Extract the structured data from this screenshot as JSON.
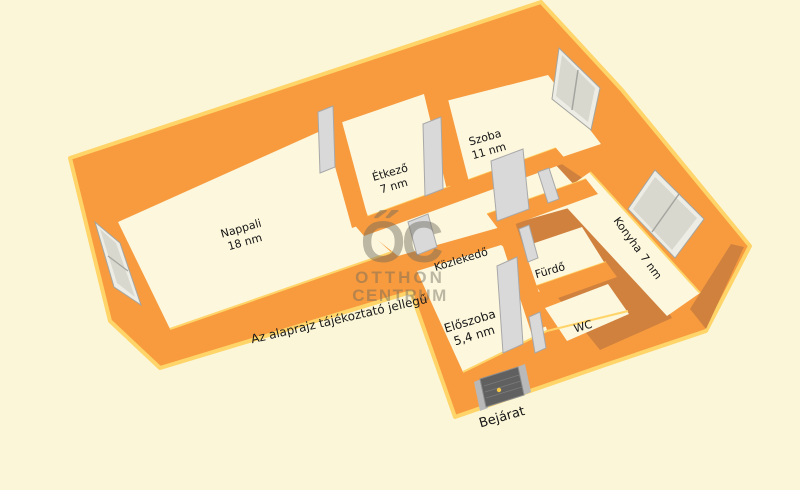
{
  "scene": {
    "disclaimer": "Az alaprajz tájékoztató jellegű",
    "entrance_label": "Bejárat"
  },
  "watermark": {
    "logo": "ŐC",
    "line1": "OTTHON",
    "line2": "CENTRUM"
  },
  "rooms": {
    "nappali": {
      "name": "Nappali",
      "area": "18 nm"
    },
    "etkezo": {
      "name": "Étkező",
      "area": "7 nm"
    },
    "szoba": {
      "name": "Szoba",
      "area": "11 nm"
    },
    "konyha": {
      "name": "Konyha",
      "area": "7 nm"
    },
    "kozlekedo": {
      "name": "Közlekedő"
    },
    "eloszoba": {
      "name": "Előszoba",
      "area": "5,4 nm"
    },
    "furdo": {
      "name": "Fürdő"
    },
    "wc": {
      "name": "WC"
    }
  },
  "colors": {
    "background": "#FBF6D7",
    "wall_bright": "#F79B3E",
    "wall_dark": "#D0813E",
    "wall_highlight": "#FFD469",
    "floor": "#FCF7DD",
    "window_glass": "#D8D8CF",
    "interior_door": "#D9D9D9",
    "entrance_door": "#606060",
    "doorknob": "#F6C845",
    "label_text": "#151515",
    "watermark": "#6E6A5E"
  }
}
